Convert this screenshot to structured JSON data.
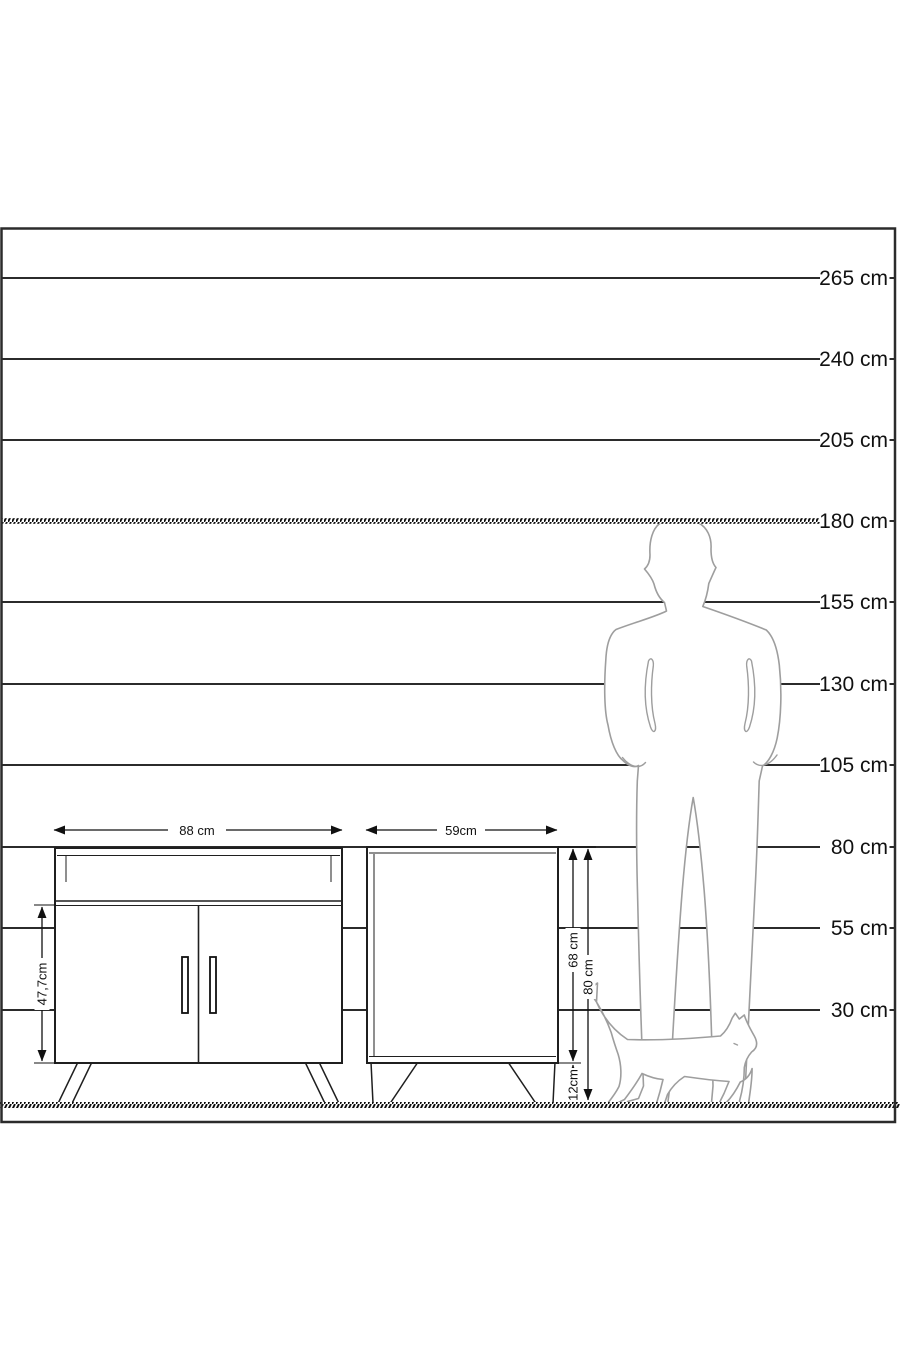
{
  "colors": {
    "background": "#ffffff",
    "frame": "#2b2b2b",
    "grid_line": "#2b2b2b",
    "hatch": "#0d0d0d",
    "furniture_outline": "#1f1f1f",
    "silhouette_outline": "#9e9e9e",
    "text": "#111111"
  },
  "scale_ruler": {
    "unit": "cm",
    "labels": [
      "265 cm",
      "240 cm",
      "205 cm",
      "180 cm",
      "155 cm",
      "130 cm",
      "105 cm",
      "80 cm",
      "55 cm",
      "30 cm"
    ],
    "values_cm": [
      265,
      240,
      205,
      180,
      155,
      130,
      105,
      80,
      55,
      30
    ],
    "hatched_line_label": "180 cm"
  },
  "dimensions": {
    "sideboard_width": "88 cm",
    "sideboard_door_height": "47,7cm",
    "cabinet_width": "59cm",
    "cabinet_body_height": "68 cm",
    "cabinet_total_height": "80 cm",
    "cabinet_leg_height": "12cm"
  },
  "icons": {
    "man": "standing-man-silhouette",
    "cat": "walking-cat-silhouette"
  }
}
